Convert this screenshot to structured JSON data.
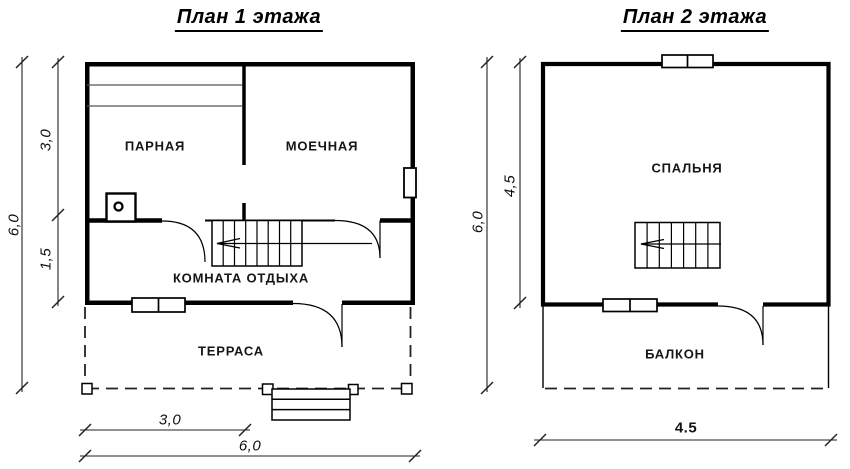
{
  "plan1": {
    "title": "План 1 этажа",
    "rooms": {
      "parnaya": "ПАРНАЯ",
      "moechnaya": "МОЕЧНАЯ",
      "komnata_otdyha": "КОМНАТА ОТДЫХА",
      "terrasa": "ТЕРРАСА"
    },
    "dims": {
      "total_height": "6,0",
      "upper_height": "3,0",
      "lower_height": "1,5",
      "bottom_inner_width": "3,0",
      "bottom_total_width": "6,0"
    }
  },
  "plan2": {
    "title": "План 2 этажа",
    "rooms": {
      "spalnya": "СПАЛЬНЯ",
      "balkon": "БАЛКОН"
    },
    "dims": {
      "total_height": "6,0",
      "room_height": "4,5",
      "bottom_width": "4.5"
    }
  },
  "colors": {
    "wall": "#000000",
    "thin_line": "#333333",
    "background": "#ffffff"
  }
}
